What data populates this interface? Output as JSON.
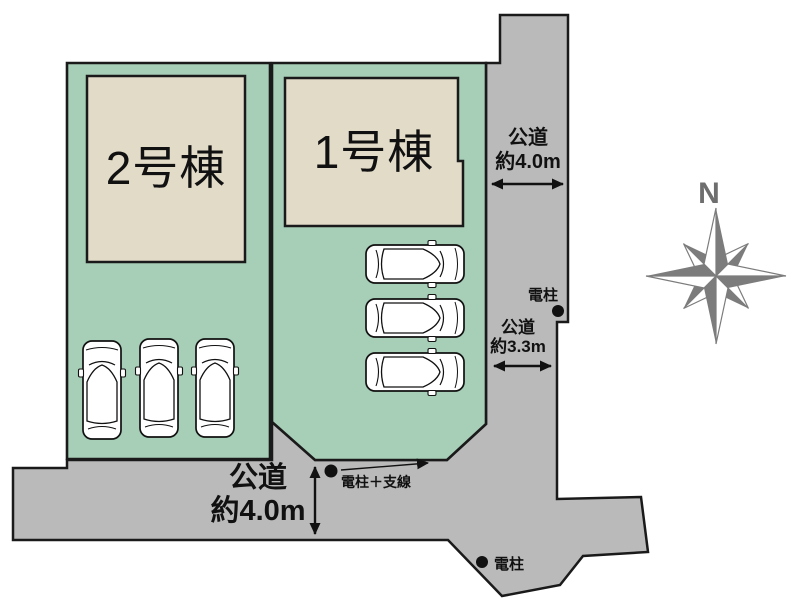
{
  "plots": [
    {
      "id": "plot-1",
      "building_label": "1号棟",
      "cars_parked": 3
    },
    {
      "id": "plot-2",
      "building_label": "2号棟",
      "cars_parked": 3
    }
  ],
  "roads": [
    {
      "id": "east-road",
      "name": "公道",
      "width": "約4.0m"
    },
    {
      "id": "southeast-road",
      "name": "公道",
      "width": "約3.3m"
    },
    {
      "id": "south-road",
      "name": "公道",
      "width": "約4.0m"
    }
  ],
  "utility_poles": [
    {
      "id": "east-pole",
      "label": "電柱"
    },
    {
      "id": "corner-pole",
      "label": "電柱＋支線"
    },
    {
      "id": "south-pole",
      "label": "電柱"
    }
  ],
  "compass": {
    "label": "N"
  },
  "colors": {
    "plot_green": "#a7ceb7",
    "building_beige": "#e2dbc8",
    "road_gray": "#bababa",
    "outline": "#1a1a1a",
    "compass_gray": "#7c7c7c"
  }
}
